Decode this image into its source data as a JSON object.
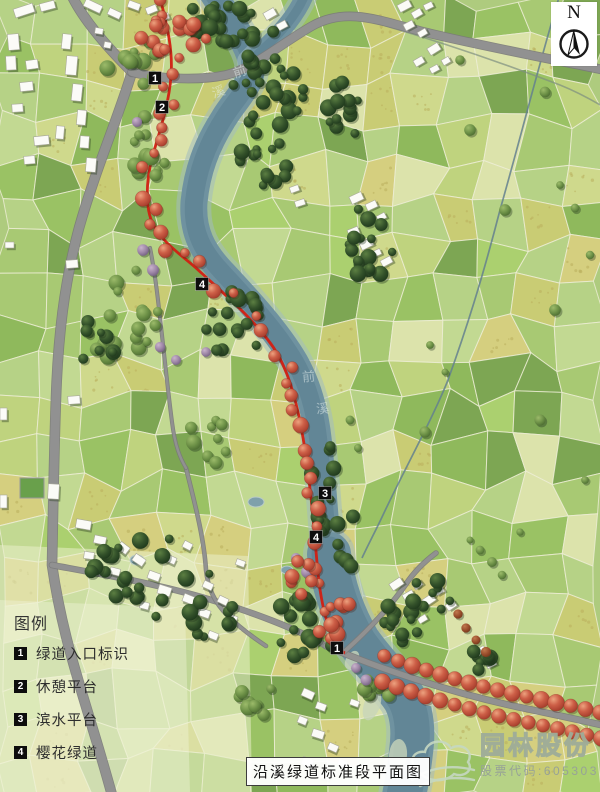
{
  "plan": {
    "title": "沿溪绿道标准段平面图"
  },
  "north": {
    "label": "N"
  },
  "legend": {
    "title": "图例",
    "items": [
      {
        "num": "1",
        "label": "绿道入口标识"
      },
      {
        "num": "2",
        "label": "休憩平台"
      },
      {
        "num": "3",
        "label": "滨水平台"
      },
      {
        "num": "4",
        "label": "樱花绿道"
      }
    ]
  },
  "map_markers": [
    {
      "num": "1",
      "x": 155,
      "y": 78
    },
    {
      "num": "2",
      "x": 162,
      "y": 107
    },
    {
      "num": "4",
      "x": 202,
      "y": 284
    },
    {
      "num": "3",
      "x": 325,
      "y": 493
    },
    {
      "num": "4",
      "x": 316,
      "y": 537
    },
    {
      "num": "1",
      "x": 337,
      "y": 648
    }
  ],
  "river_labels": [
    {
      "char": "前",
      "x": 241,
      "y": 76,
      "rot": -18
    },
    {
      "char": "溪",
      "x": 220,
      "y": 96,
      "rot": -18
    },
    {
      "char": "前",
      "x": 309,
      "y": 381,
      "rot": -5
    },
    {
      "char": "溪",
      "x": 323,
      "y": 413,
      "rot": -5
    }
  ],
  "watermark": {
    "brand": "园林股份",
    "code": "股票代码:605303"
  },
  "colors": {
    "greenway_red": "#d21f12",
    "cherry_tree": "#c65043",
    "river": "#6f92a0",
    "river_edge": "#a3bcc0",
    "road": "#919191",
    "road_edge": "#7a7a7a",
    "marker_bg": "#0d0d0d",
    "field_base": "#aecb7e"
  }
}
